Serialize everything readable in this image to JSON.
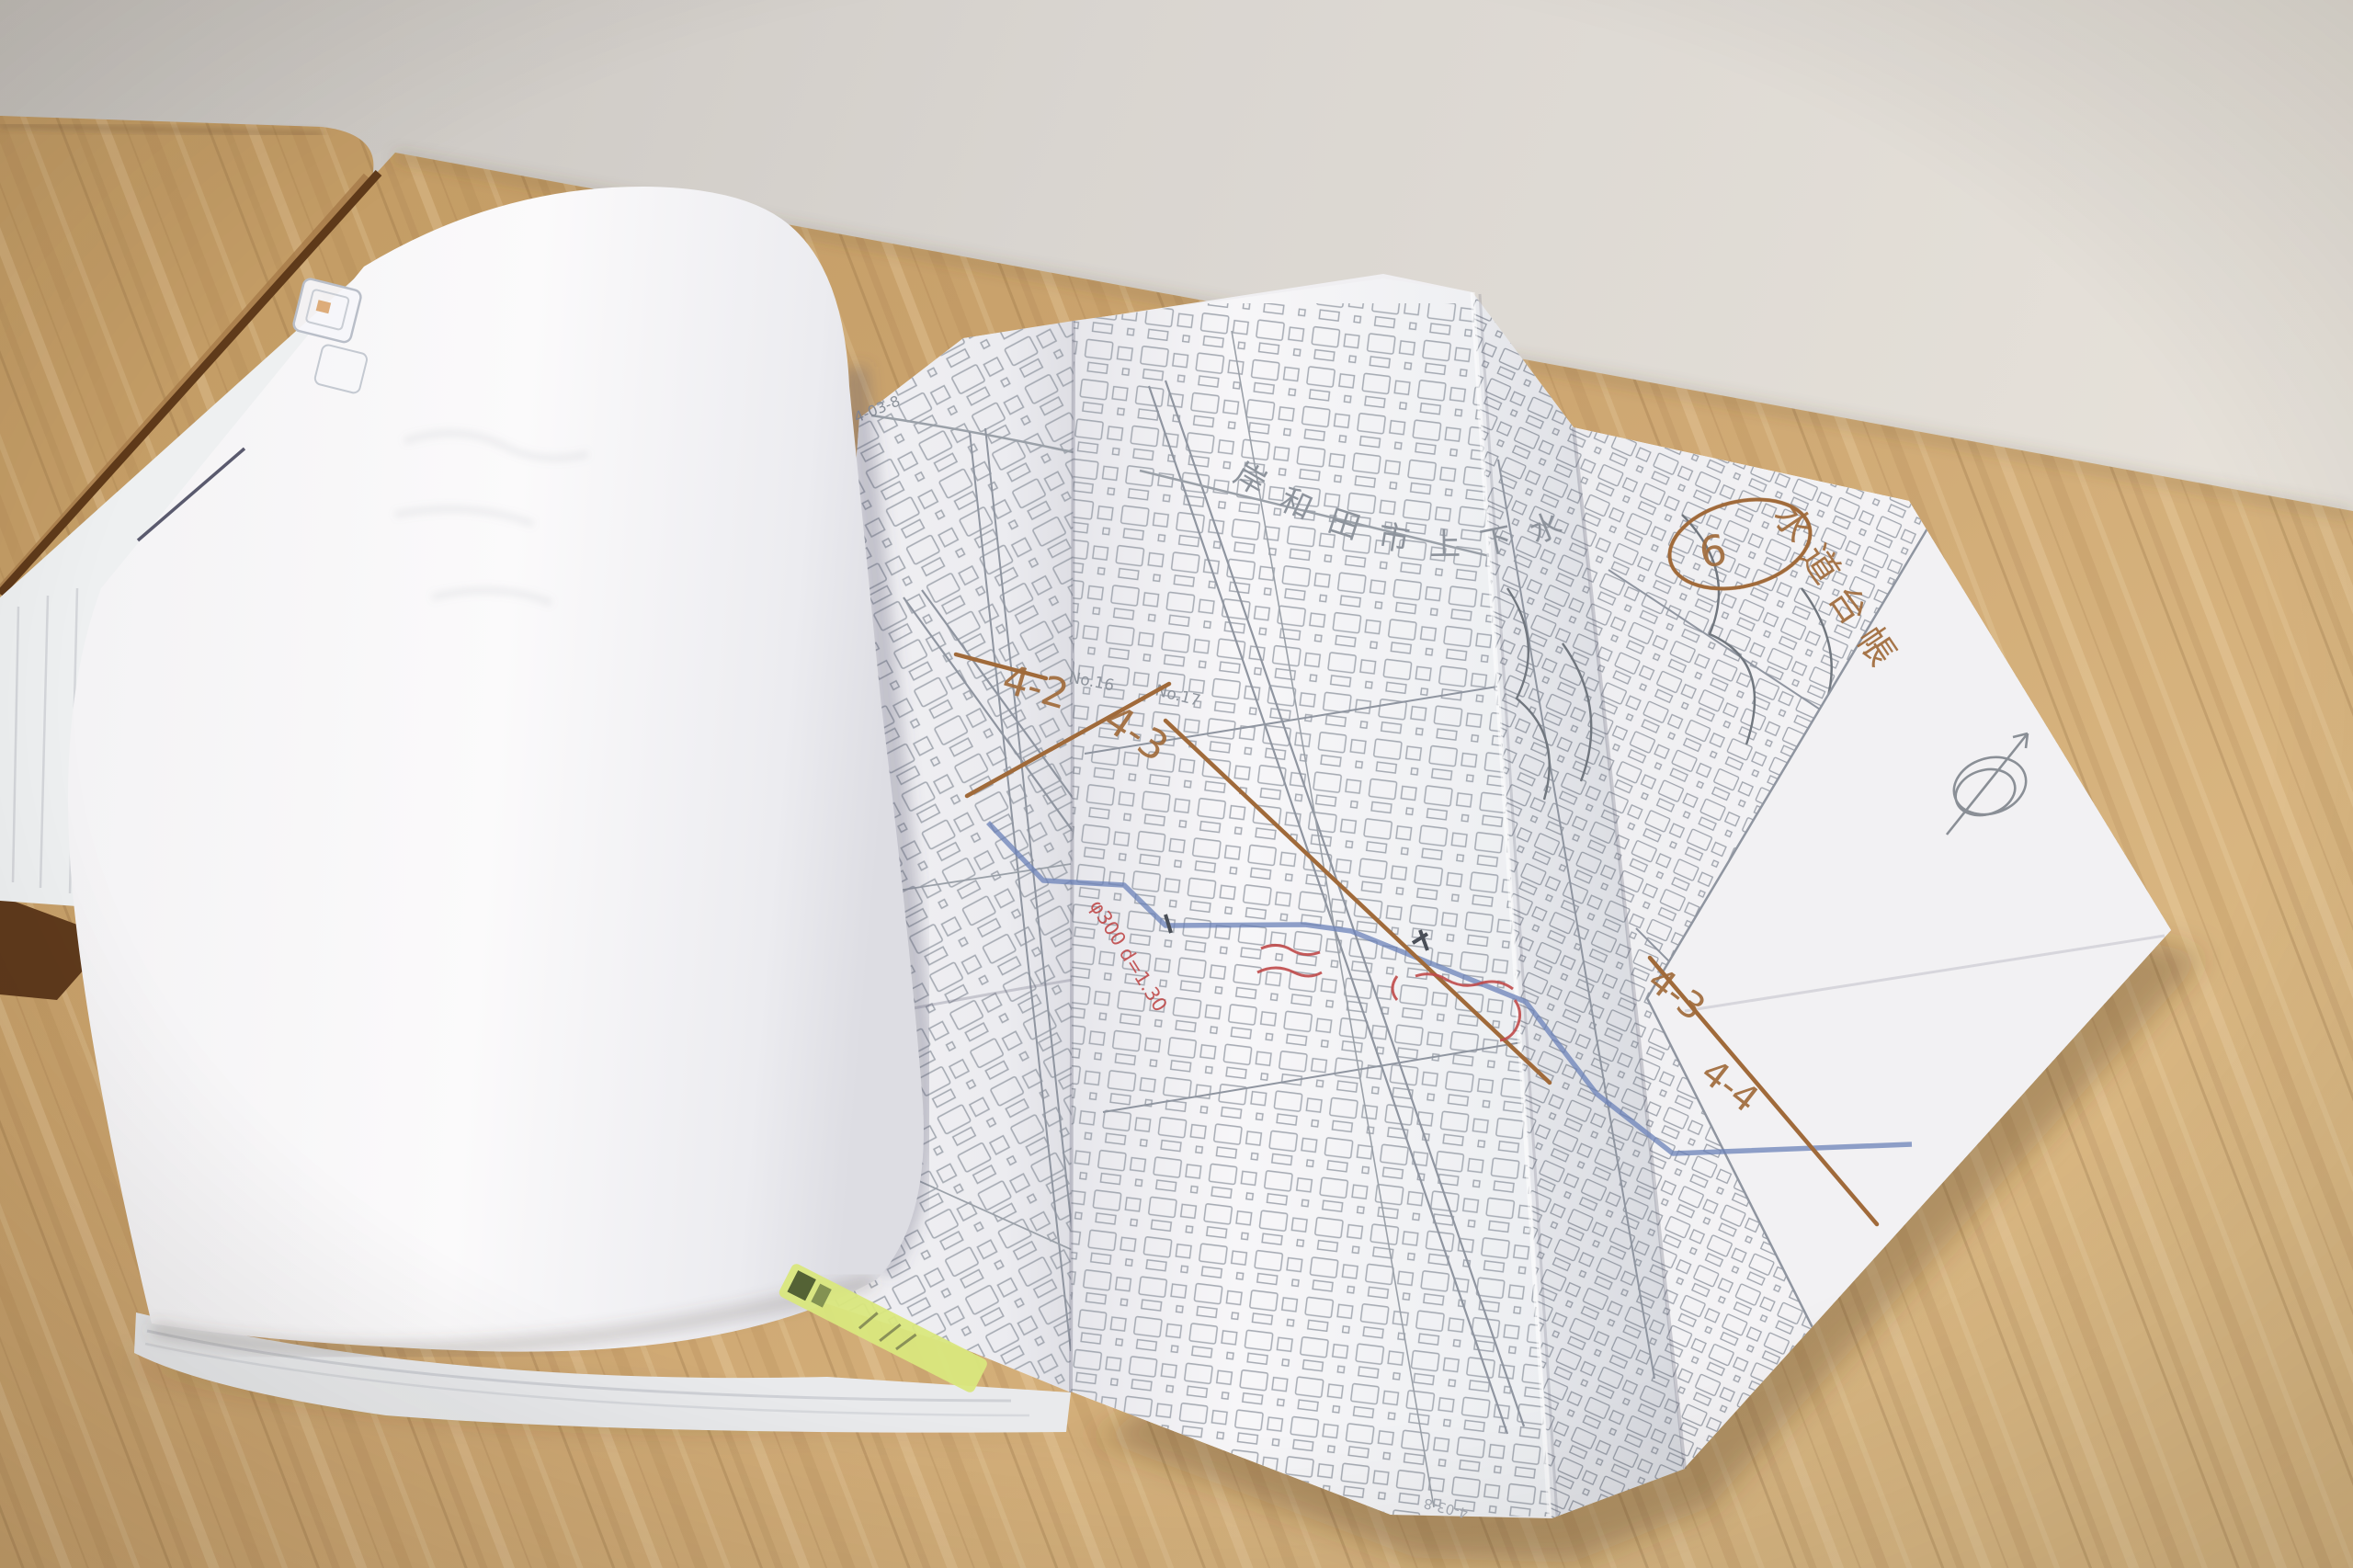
{
  "photo": {
    "map": {
      "title": "岸和田市上下水道局",
      "sheet_number": "4-03-8",
      "sheet_number_bottom": "4-03-8",
      "label_no16": "No.16",
      "label_no17": "No.17"
    },
    "handwriting": {
      "circled_number": "6",
      "ledger_label": "水道台帳",
      "section_4_2": "4-2",
      "section_4_3": "4-3",
      "section_4_3b": "4-3",
      "section_4_4": "4-4",
      "red_pipe_note": "φ300 d=1.30"
    },
    "colors": {
      "marker_orange": "#a06a3a",
      "pen_red": "#bf4a4a",
      "pipe_blue": "#6b82b8",
      "highlighter_green": "#d9e77d",
      "map_line_gray": "#8d939c",
      "desk_wood": "#c9a26b",
      "wall": "#d9d5d0",
      "paper": "#f2f1f3"
    }
  }
}
